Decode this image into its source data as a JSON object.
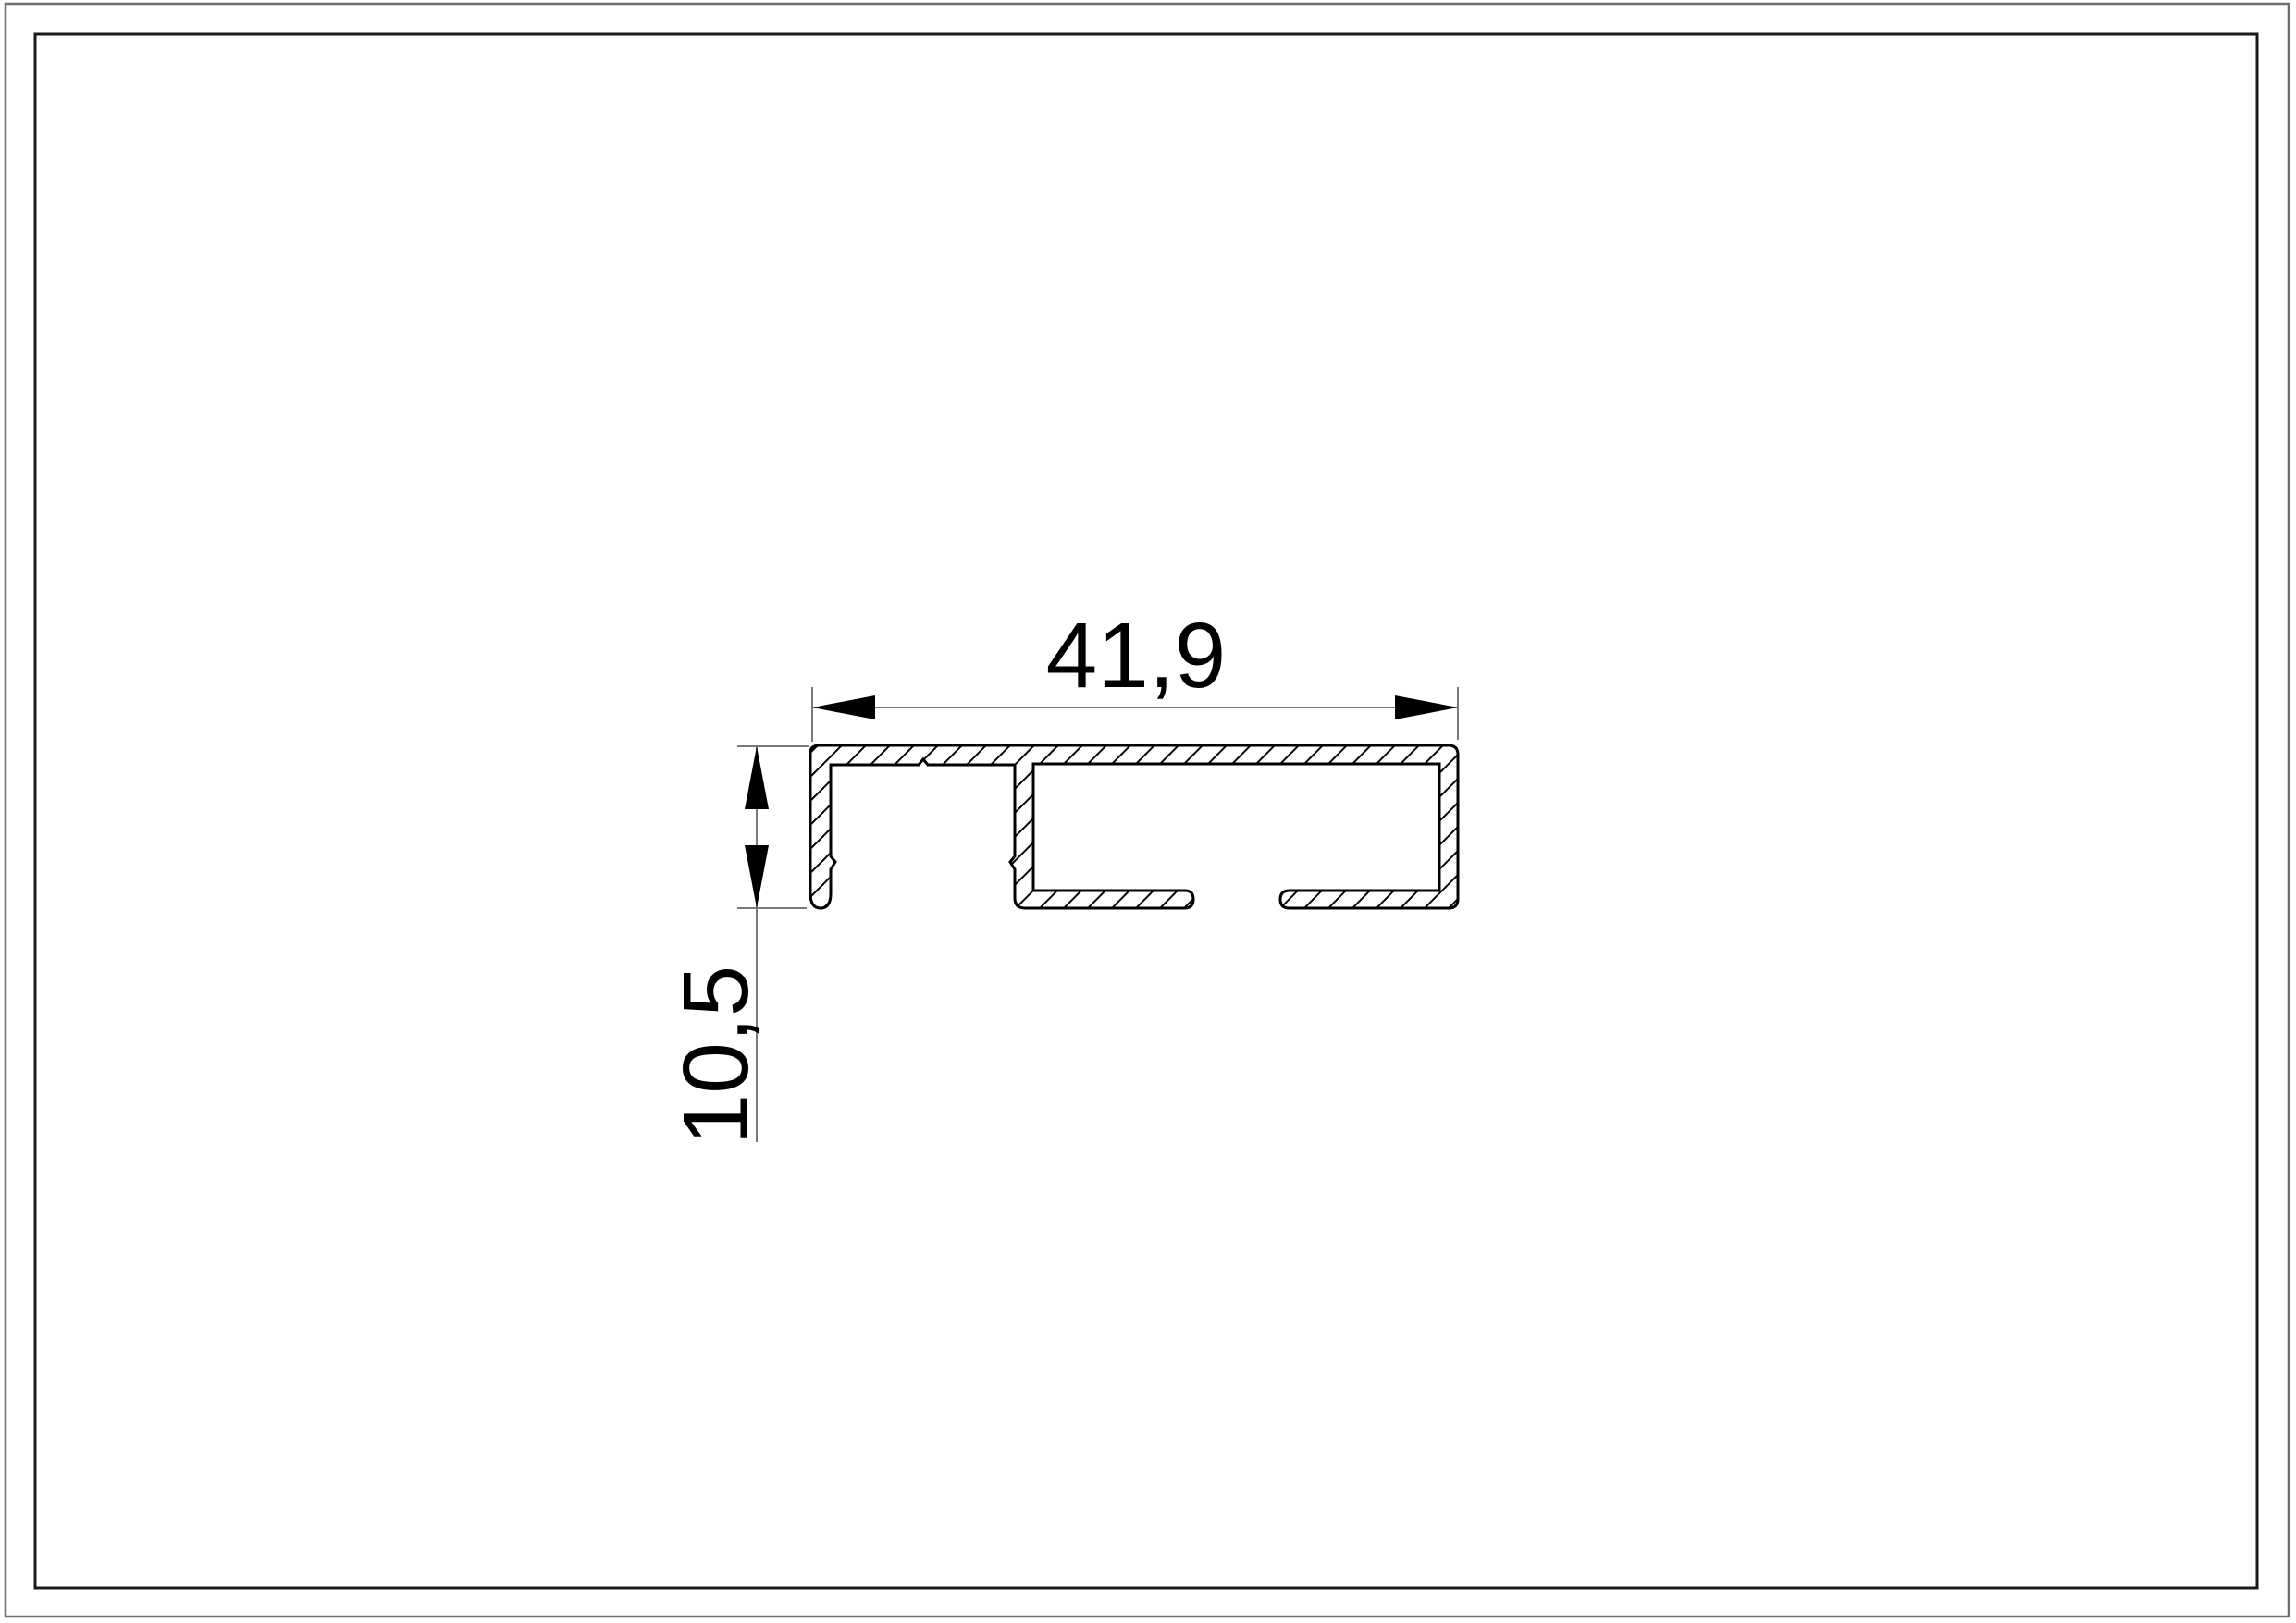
{
  "drawing": {
    "type": "technical-cross-section-profile",
    "dimensions": {
      "width_label": "41,9",
      "height_label": "10,5"
    },
    "colors": {
      "background": "#ffffff",
      "profile_outline": "#000000",
      "hatch": "#000000",
      "dimension_lines": "#7a7a7a",
      "dimension_arrows": "#000000",
      "dimension_text": "#000000",
      "frame_inner": "#1a1a1a",
      "frame_outer": "#6e6e6e"
    }
  }
}
